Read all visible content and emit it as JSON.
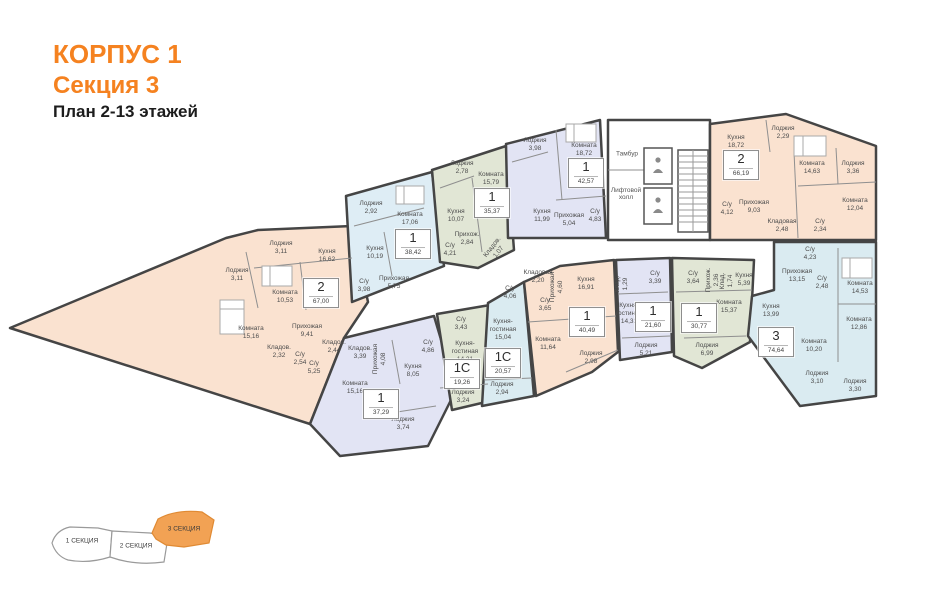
{
  "header": {
    "title_line1": "КОРПУС 1",
    "title_line2": "Секция 3",
    "title_line3": "План 2-13 этажей"
  },
  "colors": {
    "accent_orange": "#f58220",
    "inset_orange": "#f2a254",
    "fill_salmon": "#fae2d0",
    "fill_blue": "#deedf5",
    "fill_sage": "#e1e6d5",
    "fill_lavender": "#e2e4f4",
    "fill_cyan": "#daebf1",
    "wall": "#454545"
  },
  "core": {
    "tambour": "Тамбур",
    "elevator_hall": "Лифтовой холл"
  },
  "apartments": {
    "a67": {
      "type": "2",
      "area": "67,00",
      "rooms": [
        {
          "n": "Лоджия",
          "a": "3,11"
        },
        {
          "n": "Кухня",
          "a": "16,62"
        },
        {
          "n": "Комната",
          "a": "10,53"
        },
        {
          "n": "Лоджия",
          "a": "3,11"
        },
        {
          "n": "Комната",
          "a": "15,16"
        },
        {
          "n": "Прихожая",
          "a": "9,41"
        },
        {
          "n": "Кладов.",
          "a": "2,32"
        },
        {
          "n": "С/у",
          "a": "2,54"
        },
        {
          "n": "С/у",
          "a": "5,25"
        },
        {
          "n": "Кладов.",
          "a": "2,44"
        }
      ]
    },
    "a38": {
      "type": "1",
      "area": "38,42",
      "rooms": [
        {
          "n": "Лоджия",
          "a": "2,92"
        },
        {
          "n": "Комната",
          "a": "17,06"
        },
        {
          "n": "Кухня",
          "a": "10,19"
        },
        {
          "n": "С/у",
          "a": "3,98"
        },
        {
          "n": "Прихожая",
          "a": "5,75"
        }
      ]
    },
    "a35": {
      "type": "1",
      "area": "35,37",
      "rooms": [
        {
          "n": "Лоджия",
          "a": "2,78"
        },
        {
          "n": "Комната",
          "a": "15,79"
        },
        {
          "n": "Кухня",
          "a": "10,07"
        },
        {
          "n": "Прихож.",
          "a": "2,84"
        },
        {
          "n": "Кладов.",
          "a": "1,07"
        },
        {
          "n": "С/у",
          "a": "4,21"
        }
      ]
    },
    "a42": {
      "type": "1",
      "area": "42,57",
      "rooms": [
        {
          "n": "Лоджия",
          "a": "3,98"
        },
        {
          "n": "Комната",
          "a": "18,72"
        },
        {
          "n": "Кухня",
          "a": "11,99"
        },
        {
          "n": "Прихожая",
          "a": "5,04"
        },
        {
          "n": "С/у",
          "a": "4,83"
        }
      ]
    },
    "a6619": {
      "type": "2",
      "area": "66,19",
      "rooms": [
        {
          "n": "Кухня",
          "a": "18,72"
        },
        {
          "n": "Лоджия",
          "a": "2,29"
        },
        {
          "n": "Комната",
          "a": "14,63"
        },
        {
          "n": "Лоджия",
          "a": "3,36"
        },
        {
          "n": "Комната",
          "a": "12,04"
        },
        {
          "n": "Прихожая",
          "a": "9,03"
        },
        {
          "n": "С/у",
          "a": "4,12"
        },
        {
          "n": "Кладовая",
          "a": "2,48"
        },
        {
          "n": "С/у",
          "a": "2,34"
        }
      ]
    },
    "a7464": {
      "type": "3",
      "area": "74,64",
      "rooms": [
        {
          "n": "С/у",
          "a": "4,23"
        },
        {
          "n": "Прихожая",
          "a": "13,15"
        },
        {
          "n": "С/у",
          "a": "2,48"
        },
        {
          "n": "Комната",
          "a": "14,53"
        },
        {
          "n": "Кухня",
          "a": "13,99"
        },
        {
          "n": "Комната",
          "a": "12,86"
        },
        {
          "n": "Комната",
          "a": "10,20"
        },
        {
          "n": "Лоджия",
          "a": "3,10"
        },
        {
          "n": "Лоджия",
          "a": "3,30"
        }
      ]
    },
    "a3077": {
      "type": "1",
      "area": "30,77",
      "rooms": [
        {
          "n": "С/у",
          "a": "3,64"
        },
        {
          "n": "Прихож.",
          "a": "2,36"
        },
        {
          "n": "Клад.",
          "a": "1,74"
        },
        {
          "n": "Кухня",
          "a": "5,39"
        },
        {
          "n": "Комната",
          "a": "15,37"
        },
        {
          "n": "Лоджия",
          "a": "6,99"
        }
      ]
    },
    "a2160": {
      "type": "1",
      "area": "21,60",
      "rooms": [
        {
          "n": "Клад.",
          "a": "1,29"
        },
        {
          "n": "С/у",
          "a": "3,39"
        },
        {
          "n": "Кухня-гостиная",
          "a": "14,31"
        },
        {
          "n": "Лоджия",
          "a": "5,21"
        }
      ]
    },
    "a4049": {
      "type": "1",
      "area": "40,49",
      "rooms": [
        {
          "n": "Кладовая",
          "a": "2,20"
        },
        {
          "n": "Прихожая",
          "a": "4,60"
        },
        {
          "n": "Кухня",
          "a": "16,91"
        },
        {
          "n": "С/у",
          "a": "3,65"
        },
        {
          "n": "Комната",
          "a": "11,64"
        },
        {
          "n": "Лоджия",
          "a": "2,98"
        }
      ]
    },
    "a2057": {
      "type": "1С",
      "area": "20,57",
      "rooms": [
        {
          "n": "С/у",
          "a": "4,06"
        },
        {
          "n": "Кухня-гостиная",
          "a": "15,04"
        },
        {
          "n": "Лоджия",
          "a": "2,94"
        }
      ]
    },
    "a1926": {
      "type": "1С",
      "area": "19,26",
      "rooms": [
        {
          "n": "С/у",
          "a": "3,43"
        },
        {
          "n": "Кухня-гостиная",
          "a": "14,21"
        },
        {
          "n": "Лоджия",
          "a": "3,24"
        }
      ]
    },
    "a3729": {
      "type": "1",
      "area": "37,29",
      "rooms": [
        {
          "n": "Кладов.",
          "a": "3,39"
        },
        {
          "n": "Прихожая",
          "a": "4,08"
        },
        {
          "n": "С/у",
          "a": "4,86"
        },
        {
          "n": "Кухня",
          "a": "8,05"
        },
        {
          "n": "Комната",
          "a": "15,16"
        },
        {
          "n": "Лоджия",
          "a": "3,74"
        }
      ]
    }
  },
  "inset": {
    "sections": [
      {
        "label": "1 СЕКЦИЯ"
      },
      {
        "label": "2 СЕКЦИЯ"
      },
      {
        "label": "3 СЕКЦИЯ"
      }
    ]
  }
}
